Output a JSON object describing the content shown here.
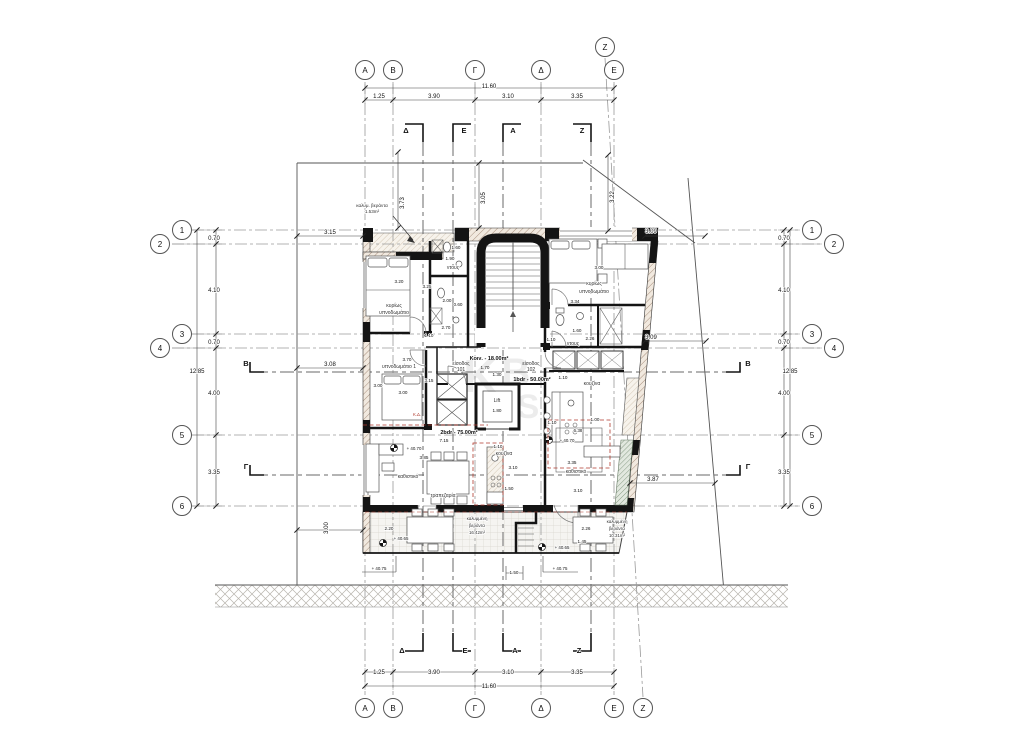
{
  "drawing": {
    "kind": "architectural floor plan",
    "overall_width_dim": "11.60",
    "overall_height_dim": "12.85"
  },
  "grid_circles": [
    {
      "t": "Α",
      "x": 365,
      "y": 70
    },
    {
      "t": "Β",
      "x": 393,
      "y": 70
    },
    {
      "t": "Γ",
      "x": 475,
      "y": 70
    },
    {
      "t": "Δ",
      "x": 541,
      "y": 70
    },
    {
      "t": "Ε",
      "x": 614,
      "y": 70
    },
    {
      "t": "Ζ",
      "x": 605,
      "y": 47
    },
    {
      "t": "Α",
      "x": 365,
      "y": 708
    },
    {
      "t": "Β",
      "x": 393,
      "y": 708
    },
    {
      "t": "Γ",
      "x": 475,
      "y": 708
    },
    {
      "t": "Δ",
      "x": 541,
      "y": 708
    },
    {
      "t": "Ε",
      "x": 614,
      "y": 708
    },
    {
      "t": "Ζ",
      "x": 643,
      "y": 708
    },
    {
      "t": "1",
      "x": 182,
      "y": 230
    },
    {
      "t": "2",
      "x": 160,
      "y": 244
    },
    {
      "t": "3",
      "x": 182,
      "y": 334
    },
    {
      "t": "4",
      "x": 160,
      "y": 348
    },
    {
      "t": "5",
      "x": 182,
      "y": 435
    },
    {
      "t": "6",
      "x": 182,
      "y": 506
    },
    {
      "t": "1",
      "x": 812,
      "y": 230
    },
    {
      "t": "2",
      "x": 834,
      "y": 244
    },
    {
      "t": "3",
      "x": 812,
      "y": 334
    },
    {
      "t": "4",
      "x": 834,
      "y": 348
    },
    {
      "t": "5",
      "x": 812,
      "y": 435
    },
    {
      "t": "6",
      "x": 812,
      "y": 506
    }
  ],
  "dim_labels": [
    {
      "t": "11.60",
      "x": 489,
      "y": 88
    },
    {
      "t": "1.25",
      "x": 379,
      "y": 98
    },
    {
      "t": "3.90",
      "x": 434,
      "y": 98
    },
    {
      "t": "3.10",
      "x": 508,
      "y": 98
    },
    {
      "t": "3.35",
      "x": 577,
      "y": 98
    },
    {
      "t": "1.25",
      "x": 379,
      "y": 674
    },
    {
      "t": "3.90",
      "x": 434,
      "y": 674
    },
    {
      "t": "3.10",
      "x": 508,
      "y": 674
    },
    {
      "t": "3.35",
      "x": 577,
      "y": 674
    },
    {
      "t": "11.60",
      "x": 489,
      "y": 688
    },
    {
      "t": "0.70",
      "x": 214,
      "y": 240
    },
    {
      "t": "4.10",
      "x": 214,
      "y": 292
    },
    {
      "t": "0.70",
      "x": 214,
      "y": 344
    },
    {
      "t": "4.00",
      "x": 214,
      "y": 395
    },
    {
      "t": "3.35",
      "x": 214,
      "y": 474
    },
    {
      "t": "12.85",
      "x": 197,
      "y": 373
    },
    {
      "t": "0.70",
      "x": 784,
      "y": 240
    },
    {
      "t": "4.10",
      "x": 784,
      "y": 292
    },
    {
      "t": "0.70",
      "x": 784,
      "y": 344
    },
    {
      "t": "4.00",
      "x": 784,
      "y": 395
    },
    {
      "t": "3.35",
      "x": 784,
      "y": 474
    },
    {
      "t": "12.85",
      "x": 790,
      "y": 373
    },
    {
      "t": "3.15",
      "x": 330,
      "y": 234
    },
    {
      "t": "3.08",
      "x": 330,
      "y": 366
    },
    {
      "t": "3.00",
      "x": 328,
      "y": 528,
      "r": -90
    },
    {
      "t": "3.73",
      "x": 404,
      "y": 203,
      "r": -90
    },
    {
      "t": "3.05",
      "x": 485,
      "y": 198,
      "r": -90
    },
    {
      "t": "3.22",
      "x": 614,
      "y": 197,
      "r": -90
    },
    {
      "t": "3.09",
      "x": 651,
      "y": 233
    },
    {
      "t": "3.09",
      "x": 651,
      "y": 339
    },
    {
      "t": "3.87",
      "x": 653,
      "y": 481
    }
  ],
  "room_dims": [
    {
      "t": "3.20",
      "x": 399,
      "y": 283
    },
    {
      "t": "3.25",
      "x": 427,
      "y": 288
    },
    {
      "t": "1.60",
      "x": 456,
      "y": 249
    },
    {
      "t": "1.90",
      "x": 450,
      "y": 260
    },
    {
      "t": "2.00",
      "x": 447,
      "y": 302
    },
    {
      "t": "0.60",
      "x": 458,
      "y": 306
    },
    {
      "t": "2.70",
      "x": 446,
      "y": 329
    },
    {
      "t": "1.10",
      "x": 429,
      "y": 337
    },
    {
      "t": "3.70",
      "x": 407,
      "y": 361
    },
    {
      "t": "3.00",
      "x": 378,
      "y": 387
    },
    {
      "t": "3.00",
      "x": 403,
      "y": 394
    },
    {
      "t": "3.15",
      "x": 429,
      "y": 382
    },
    {
      "t": "1.70",
      "x": 485,
      "y": 369
    },
    {
      "t": "1.30",
      "x": 497,
      "y": 376
    },
    {
      "t": "1.80",
      "x": 497,
      "y": 412
    },
    {
      "t": "1.10",
      "x": 563,
      "y": 379
    },
    {
      "t": "1.10",
      "x": 552,
      "y": 424
    },
    {
      "t": "1.00",
      "x": 595,
      "y": 421
    },
    {
      "t": "6.38",
      "x": 578,
      "y": 432
    },
    {
      "t": "7.15",
      "x": 444,
      "y": 442
    },
    {
      "t": "3.85",
      "x": 424,
      "y": 459
    },
    {
      "t": "1.10",
      "x": 498,
      "y": 448
    },
    {
      "t": "3.10",
      "x": 513,
      "y": 469
    },
    {
      "t": "1.50",
      "x": 509,
      "y": 490
    },
    {
      "t": "3.35",
      "x": 572,
      "y": 464
    },
    {
      "t": "3.10",
      "x": 578,
      "y": 492
    },
    {
      "t": "1.10",
      "x": 551,
      "y": 341
    },
    {
      "t": "1.60",
      "x": 577,
      "y": 332
    },
    {
      "t": "2.26",
      "x": 590,
      "y": 340
    },
    {
      "t": "3.00",
      "x": 599,
      "y": 269
    },
    {
      "t": "3.34",
      "x": 575,
      "y": 303
    },
    {
      "t": "2.20",
      "x": 389,
      "y": 530
    },
    {
      "t": "2.26",
      "x": 586,
      "y": 530
    },
    {
      "t": "1.45",
      "x": 582,
      "y": 543
    },
    {
      "t": "1.50",
      "x": 514,
      "y": 574
    }
  ],
  "room_labels": [
    {
      "t": "κυρίως",
      "x": 394,
      "y": 307
    },
    {
      "t": "υπνοδωμάτιο",
      "x": 394,
      "y": 314
    },
    {
      "t": "ντους",
      "x": 453,
      "y": 269
    },
    {
      "t": "υπνοδωμάτιο 1",
      "x": 399,
      "y": 368
    },
    {
      "t": "είσοδος",
      "x": 461,
      "y": 365
    },
    {
      "t": "101",
      "x": 461,
      "y": 371
    },
    {
      "t": "είσοδος",
      "x": 531,
      "y": 365
    },
    {
      "t": "102",
      "x": 531,
      "y": 371
    },
    {
      "t": "Lift",
      "x": 497,
      "y": 402
    },
    {
      "t": "κουζίνα",
      "x": 592,
      "y": 385
    },
    {
      "t": "κυρίως",
      "x": 594,
      "y": 285
    },
    {
      "t": "υπνοδωμάτιο",
      "x": 594,
      "y": 293
    },
    {
      "t": "ντους",
      "x": 573,
      "y": 345
    },
    {
      "t": "καθιστικό",
      "x": 408,
      "y": 478
    },
    {
      "t": "τραπεζαρία",
      "x": 443,
      "y": 497
    },
    {
      "t": "κουζίνα",
      "x": 504,
      "y": 455
    },
    {
      "t": "καθιστικό",
      "x": 576,
      "y": 473
    },
    {
      "t": "καλυμμένη",
      "x": 477,
      "y": 520,
      "s": 4.4
    },
    {
      "t": "βεράντα",
      "x": 477,
      "y": 527,
      "s": 4.4
    },
    {
      "t": "16.42m²",
      "x": 477,
      "y": 534,
      "s": 4.4
    },
    {
      "t": "καλυμμένη",
      "x": 617,
      "y": 523,
      "s": 4.4
    },
    {
      "t": "βεράντα",
      "x": 617,
      "y": 530,
      "s": 4.4
    },
    {
      "t": "10.31m²",
      "x": 617,
      "y": 537,
      "s": 4.4
    },
    {
      "t": "καλυμ. βεράντα",
      "x": 372,
      "y": 207,
      "s": 4.6
    },
    {
      "t": "1.53m²",
      "x": 372,
      "y": 213,
      "s": 4.6
    }
  ],
  "area_labels": [
    {
      "t": "Κοιν. - 18.00m²",
      "x": 489,
      "y": 360
    },
    {
      "t": "2bdr - 75.00m²",
      "x": 459,
      "y": 434
    },
    {
      "t": "1bdr - 50.00m²",
      "x": 532,
      "y": 381
    }
  ],
  "level_labels": [
    {
      "t": "+ 40.70",
      "x": 414,
      "y": 450
    },
    {
      "t": "+ 40.70",
      "x": 567,
      "y": 442
    },
    {
      "t": "+ 40.65",
      "x": 401,
      "y": 540
    },
    {
      "t": "+ 40.65",
      "x": 562,
      "y": 549
    },
    {
      "t": "+ 40.75",
      "x": 379,
      "y": 570
    },
    {
      "t": "+ 40.75",
      "x": 560,
      "y": 570
    }
  ],
  "section_letters": [
    {
      "t": "Δ",
      "x": 406,
      "y": 133
    },
    {
      "t": "Ε",
      "x": 464,
      "y": 133
    },
    {
      "t": "Α",
      "x": 513,
      "y": 133
    },
    {
      "t": "Ζ",
      "x": 582,
      "y": 133
    },
    {
      "t": "Δ",
      "x": 402,
      "y": 653
    },
    {
      "t": "Ε",
      "x": 465,
      "y": 653
    },
    {
      "t": "Α",
      "x": 515,
      "y": 653
    },
    {
      "t": "Ζ",
      "x": 579,
      "y": 653
    },
    {
      "t": "Β",
      "x": 246,
      "y": 366
    },
    {
      "t": "Β",
      "x": 748,
      "y": 366
    },
    {
      "t": "Γ",
      "x": 246,
      "y": 469
    },
    {
      "t": "Γ",
      "x": 748,
      "y": 469
    }
  ],
  "red_notes": [
    {
      "t": "Κ.Δ.",
      "x": 417,
      "y": 416
    }
  ],
  "watermark_letters": [
    {
      "t": "Κ",
      "x": 480,
      "y": 392,
      "s": 46
    },
    {
      "t": "Β",
      "x": 516,
      "y": 386,
      "s": 40
    },
    {
      "t": "S",
      "x": 528,
      "y": 418,
      "s": 34
    }
  ]
}
